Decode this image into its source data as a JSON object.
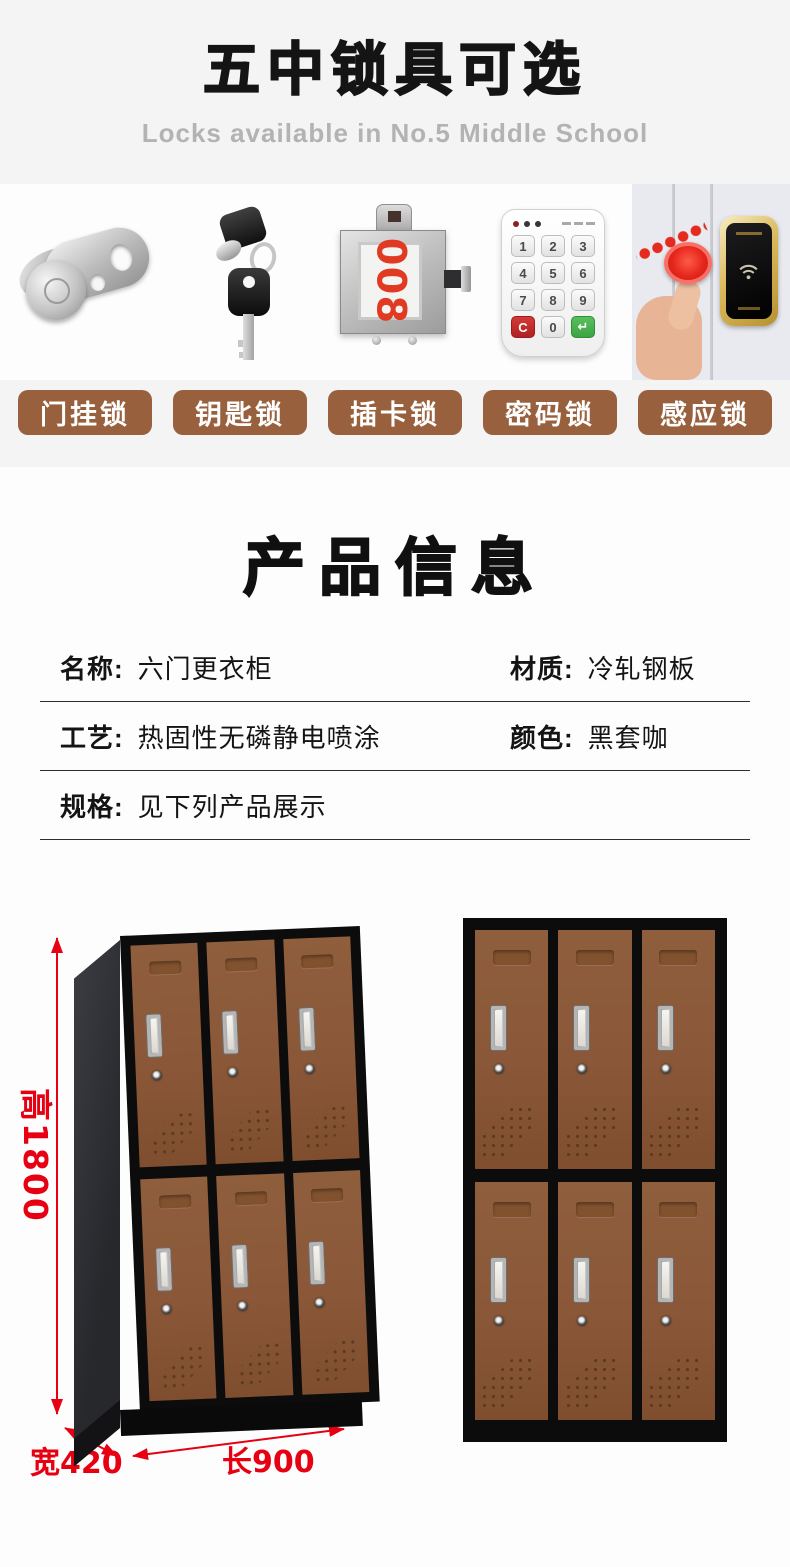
{
  "header": {
    "title": "五中锁具可选",
    "subtitle": "Locks available in No.5 Middle School"
  },
  "locks": {
    "items": [
      {
        "label": "门挂锁",
        "icon": "hasp-lock-icon"
      },
      {
        "label": "钥匙锁",
        "icon": "key-lock-icon"
      },
      {
        "label": "插卡锁",
        "icon": "card-lock-icon",
        "number": "008"
      },
      {
        "label": "密码锁",
        "icon": "keypad-lock-icon"
      },
      {
        "label": "感应锁",
        "icon": "induction-lock-icon"
      }
    ],
    "keypad_keys": [
      "1",
      "2",
      "3",
      "4",
      "5",
      "6",
      "7",
      "8",
      "9",
      "C",
      "0",
      "↵"
    ],
    "label_bg_color": "#99603E"
  },
  "product_info": {
    "title": "产品信息",
    "rows": [
      {
        "label": "名称:",
        "value": "六门更衣柜"
      },
      {
        "label": "材质:",
        "value": "冷轧钢板"
      },
      {
        "label": "工艺:",
        "value": "热固性无磷静电喷涂"
      },
      {
        "label": "颜色:",
        "value": "黑套咖"
      },
      {
        "label": "规格:",
        "value": "见下列产品展示"
      }
    ]
  },
  "dimensions": {
    "height": "高1800",
    "width": "宽420",
    "length": "长900",
    "annotation_color": "#E60012"
  },
  "locker": {
    "door_count": 6,
    "door_color": "#8A5838",
    "frame_color": "#0C0C0C"
  }
}
